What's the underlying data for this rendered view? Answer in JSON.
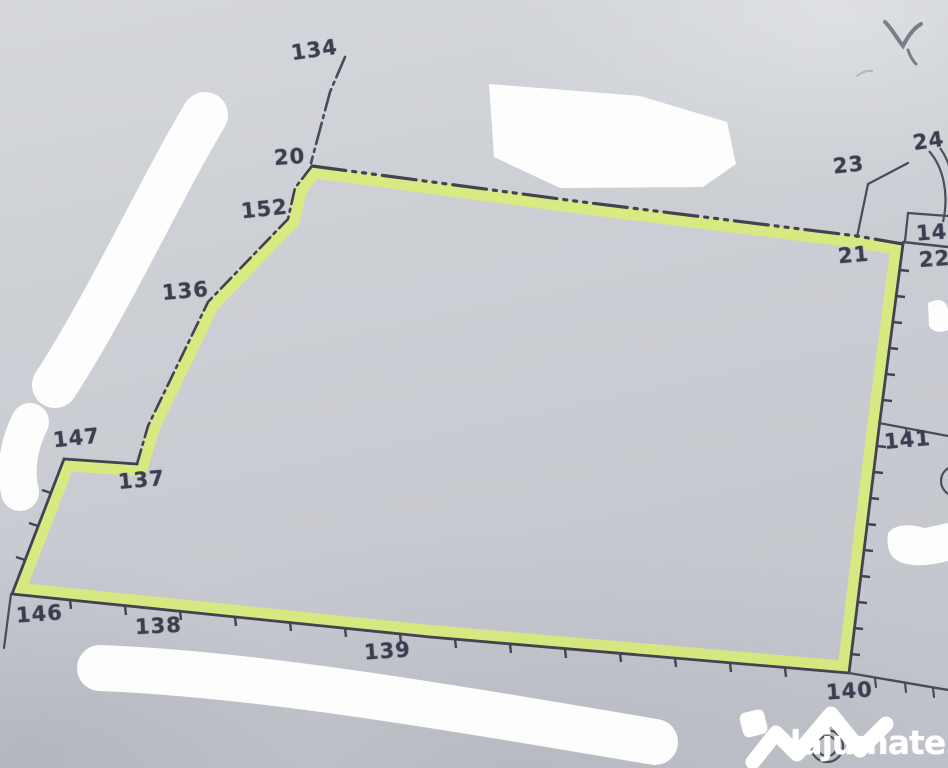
{
  "map": {
    "type": "cadastral-plan",
    "highlight_color": "#dcef70",
    "ink_color": "#3f4450",
    "paper_color": "#cbced4",
    "points": [
      {
        "label": "134"
      },
      {
        "label": "20"
      },
      {
        "label": "152"
      },
      {
        "label": "136"
      },
      {
        "label": "147"
      },
      {
        "label": "137"
      },
      {
        "label": "146"
      },
      {
        "label": "138"
      },
      {
        "label": "139"
      },
      {
        "label": "140"
      },
      {
        "label": "141"
      },
      {
        "label": "21"
      },
      {
        "label": "22"
      },
      {
        "label": "142"
      },
      {
        "label": "23"
      },
      {
        "label": "24"
      }
    ],
    "handwriting": {
      "text": "V"
    }
  },
  "watermark": {
    "brand": "lajumate",
    "tld": ".ro",
    "tld_color": "#93dbd2"
  }
}
